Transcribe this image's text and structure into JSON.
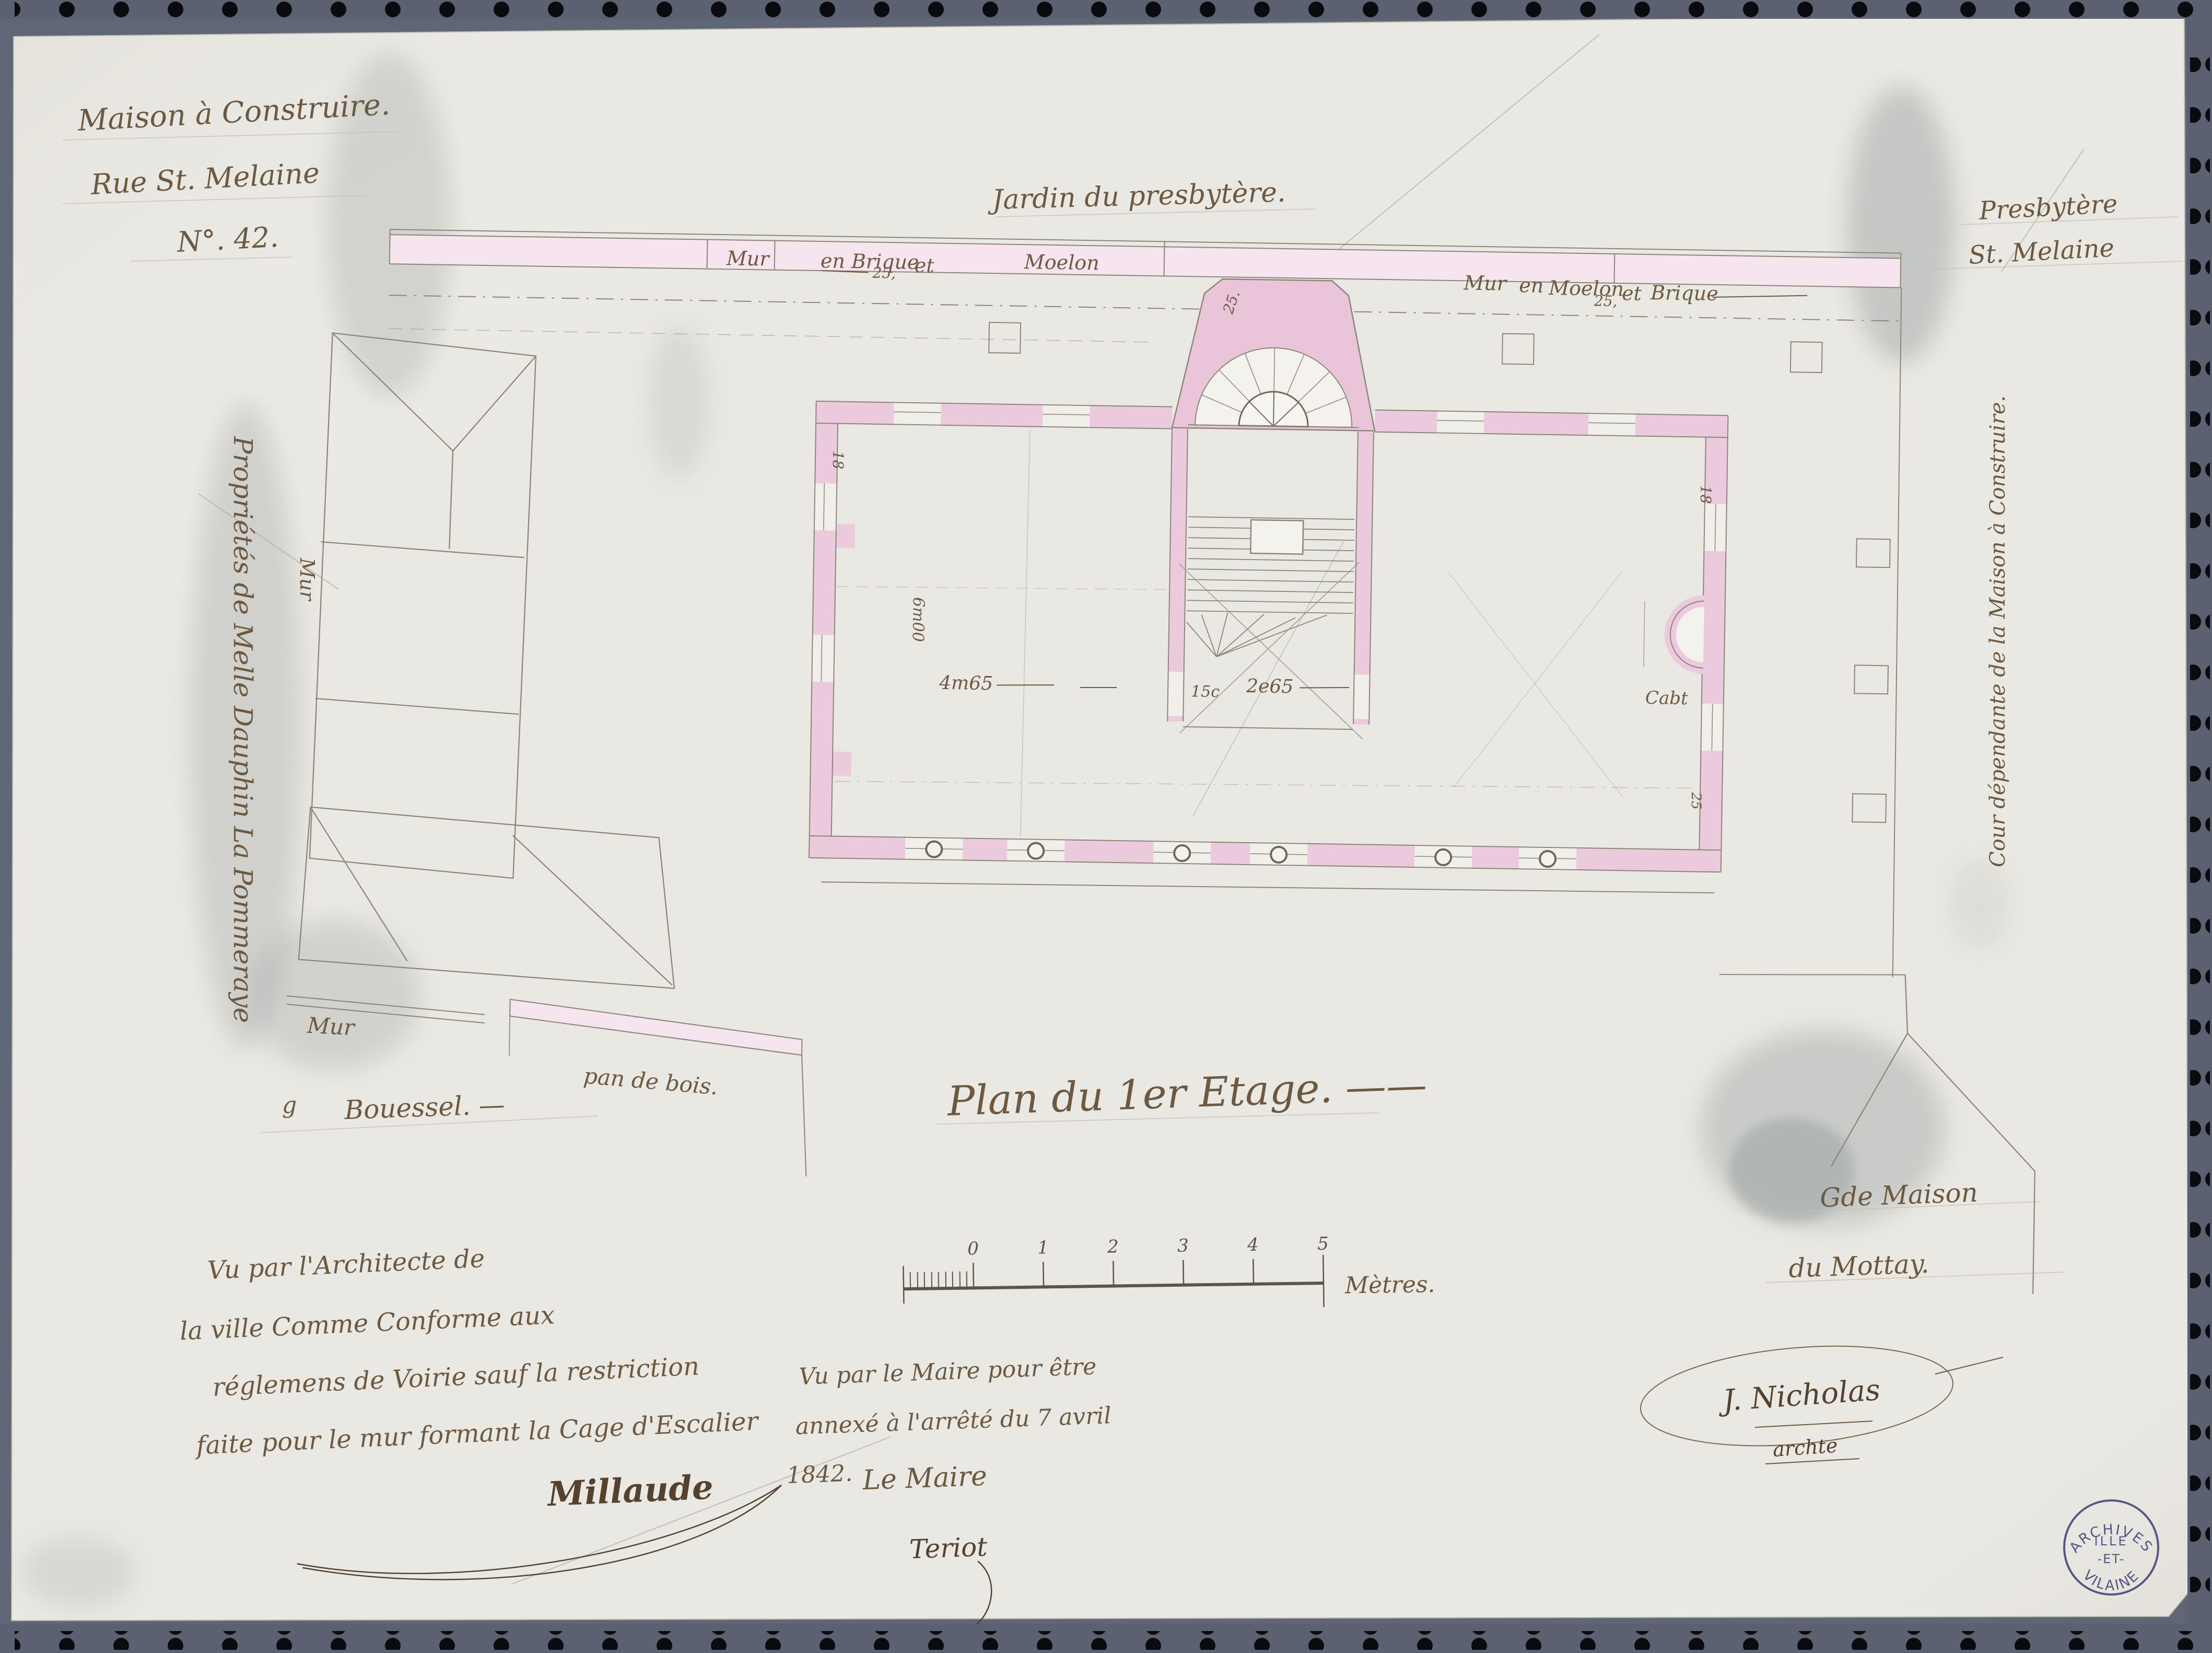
{
  "colors": {
    "film": "#666d7c",
    "paper": "#eae8e2",
    "ink": "#6d5940",
    "ink_dark": "#54422e",
    "wall_pink": "#eccade",
    "wall_pink_light": "#f6e4ee",
    "pencil": "#8a8478",
    "stamp_ink": "#44427a"
  },
  "title_block": {
    "line1": "Maison à Construire.",
    "line2": "Rue St. Melaine",
    "line3": "N°. 42."
  },
  "garden": {
    "label": "Jardin du presbytère."
  },
  "presbytery": {
    "line1": "Presbytère",
    "line2": "St. Melaine"
  },
  "wall_labels": {
    "left": {
      "w1": "Mur",
      "w2": "en Brique",
      "w3": "25,",
      "w4": "et",
      "w5": "Moelon"
    },
    "right": {
      "w1": "Mur",
      "w2": "en",
      "w3": "Moelon",
      "w4": "25,",
      "w5": "et",
      "w6": "Brique"
    },
    "mur": "Mur",
    "pan_de_bois": "pan de bois.",
    "mur_vertical": "Mur"
  },
  "side_labels": {
    "left_property": "Propriétés de Melle Dauphin La Pommeraye",
    "right_court": "Cour dépendante de la Maison à Construire."
  },
  "plan": {
    "title": "Plan du 1er Etage. ——",
    "owner_left_mark": "g",
    "owner_left": "Bouessel. —",
    "neighbor_line1": "Gde Maison",
    "neighbor_line2": "du Mottay."
  },
  "dimensions": {
    "d1": "4m65",
    "d2": "15c",
    "d3": "2e65",
    "d4": "6m00",
    "d5": "18",
    "d6": "18",
    "d7": "25.",
    "d8": "25",
    "cab": "Cabt"
  },
  "scale_bar": {
    "ticks": [
      "0",
      "1",
      "2",
      "3",
      "4",
      "5"
    ],
    "unit": "Mètres."
  },
  "architect_note": {
    "line1": "Vu par l'Architecte de",
    "line2": "la ville Comme Conforme aux",
    "line3": "réglemens de Voirie sauf la restriction",
    "line4": "faite pour le mur formant la Cage d'Escalier",
    "signature": "Millaude"
  },
  "mayor_note": {
    "line1": "Vu par le Maire pour être",
    "line2": "annexé à l'arrêté du 7 avril",
    "line3": "1842.",
    "line4": "Le Maire",
    "signature": "Teriot"
  },
  "architect_signature": {
    "name": "J. Nicholas",
    "title": "archte"
  },
  "stamp": {
    "arc_top": "ARCHIVES",
    "line1": "ILLE",
    "line2": "-ET-",
    "arc_bottom": "VILAINE"
  }
}
